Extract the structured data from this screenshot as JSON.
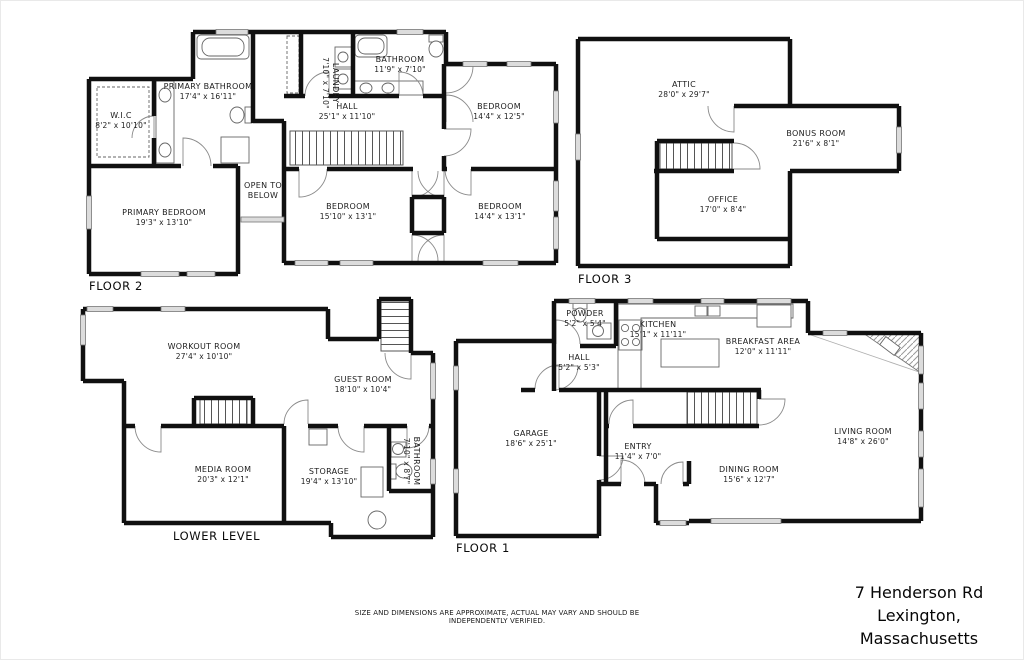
{
  "floors": {
    "floor2": {
      "label": "FLOOR 2",
      "rooms": {
        "primary_bathroom": {
          "name": "PRIMARY BATHROOM",
          "dims": "17'4\" x 16'11\""
        },
        "wic": {
          "name": "W.I.C",
          "dims": "8'2\" x 10'10\""
        },
        "laundry": {
          "name": "LAUNDRY",
          "dims": "7'10\" x 7'10\""
        },
        "bathroom": {
          "name": "BATHROOM",
          "dims": "11'9\" x 7'10\""
        },
        "hall": {
          "name": "HALL",
          "dims": "25'1\" x 11'10\""
        },
        "bedroom_top": {
          "name": "BEDROOM",
          "dims": "14'4\" x 12'5\""
        },
        "open_to_below": {
          "name": "OPEN TO BELOW"
        },
        "primary_bedroom": {
          "name": "PRIMARY BEDROOM",
          "dims": "19'3\" x 13'10\""
        },
        "bedroom_left": {
          "name": "BEDROOM",
          "dims": "15'10\" x 13'1\""
        },
        "bedroom_right": {
          "name": "BEDROOM",
          "dims": "14'4\" x 13'1\""
        }
      }
    },
    "floor3": {
      "label": "FLOOR 3",
      "rooms": {
        "attic": {
          "name": "ATTIC",
          "dims": "28'0\" x 29'7\""
        },
        "bonus_room": {
          "name": "BONUS ROOM",
          "dims": "21'6\" x 8'1\""
        },
        "office": {
          "name": "OFFICE",
          "dims": "17'0\" x 8'4\""
        }
      }
    },
    "lower_level": {
      "label": "LOWER LEVEL",
      "rooms": {
        "workout_room": {
          "name": "WORKOUT ROOM",
          "dims": "27'4\" x 10'10\""
        },
        "guest_room": {
          "name": "GUEST ROOM",
          "dims": "18'10\" x 10'4\""
        },
        "media_room": {
          "name": "MEDIA ROOM",
          "dims": "20'3\" x 12'1\""
        },
        "storage": {
          "name": "STORAGE",
          "dims": "19'4\" x 13'10\""
        },
        "bathroom": {
          "name": "BATHROOM",
          "dims": "7'10\" x 8'7\""
        }
      }
    },
    "floor1": {
      "label": "FLOOR 1",
      "rooms": {
        "powder": {
          "name": "POWDER",
          "dims": "5'2\" x 5'4\""
        },
        "kitchen": {
          "name": "KITCHEN",
          "dims": "15'1\" x 11'11\""
        },
        "breakfast_area": {
          "name": "BREAKFAST AREA",
          "dims": "12'0\" x 11'11\""
        },
        "hall": {
          "name": "HALL",
          "dims": "5'2\" x 5'3\""
        },
        "garage": {
          "name": "GARAGE",
          "dims": "18'6\" x 25'1\""
        },
        "entry": {
          "name": "ENTRY",
          "dims": "11'4\" x 7'0\""
        },
        "dining_room": {
          "name": "DINING ROOM",
          "dims": "15'6\" x 12'7\""
        },
        "living_room": {
          "name": "LIVING ROOM",
          "dims": "14'8\" x 26'0\""
        }
      }
    }
  },
  "footer": {
    "disclaimer": "SIZE AND DIMENSIONS ARE APPROXIMATE, ACTUAL MAY VARY AND SHOULD BE INDEPENDENTLY VERIFIED.",
    "address_line1": "7 Henderson Rd",
    "address_line2": "Lexington, Massachusetts"
  }
}
